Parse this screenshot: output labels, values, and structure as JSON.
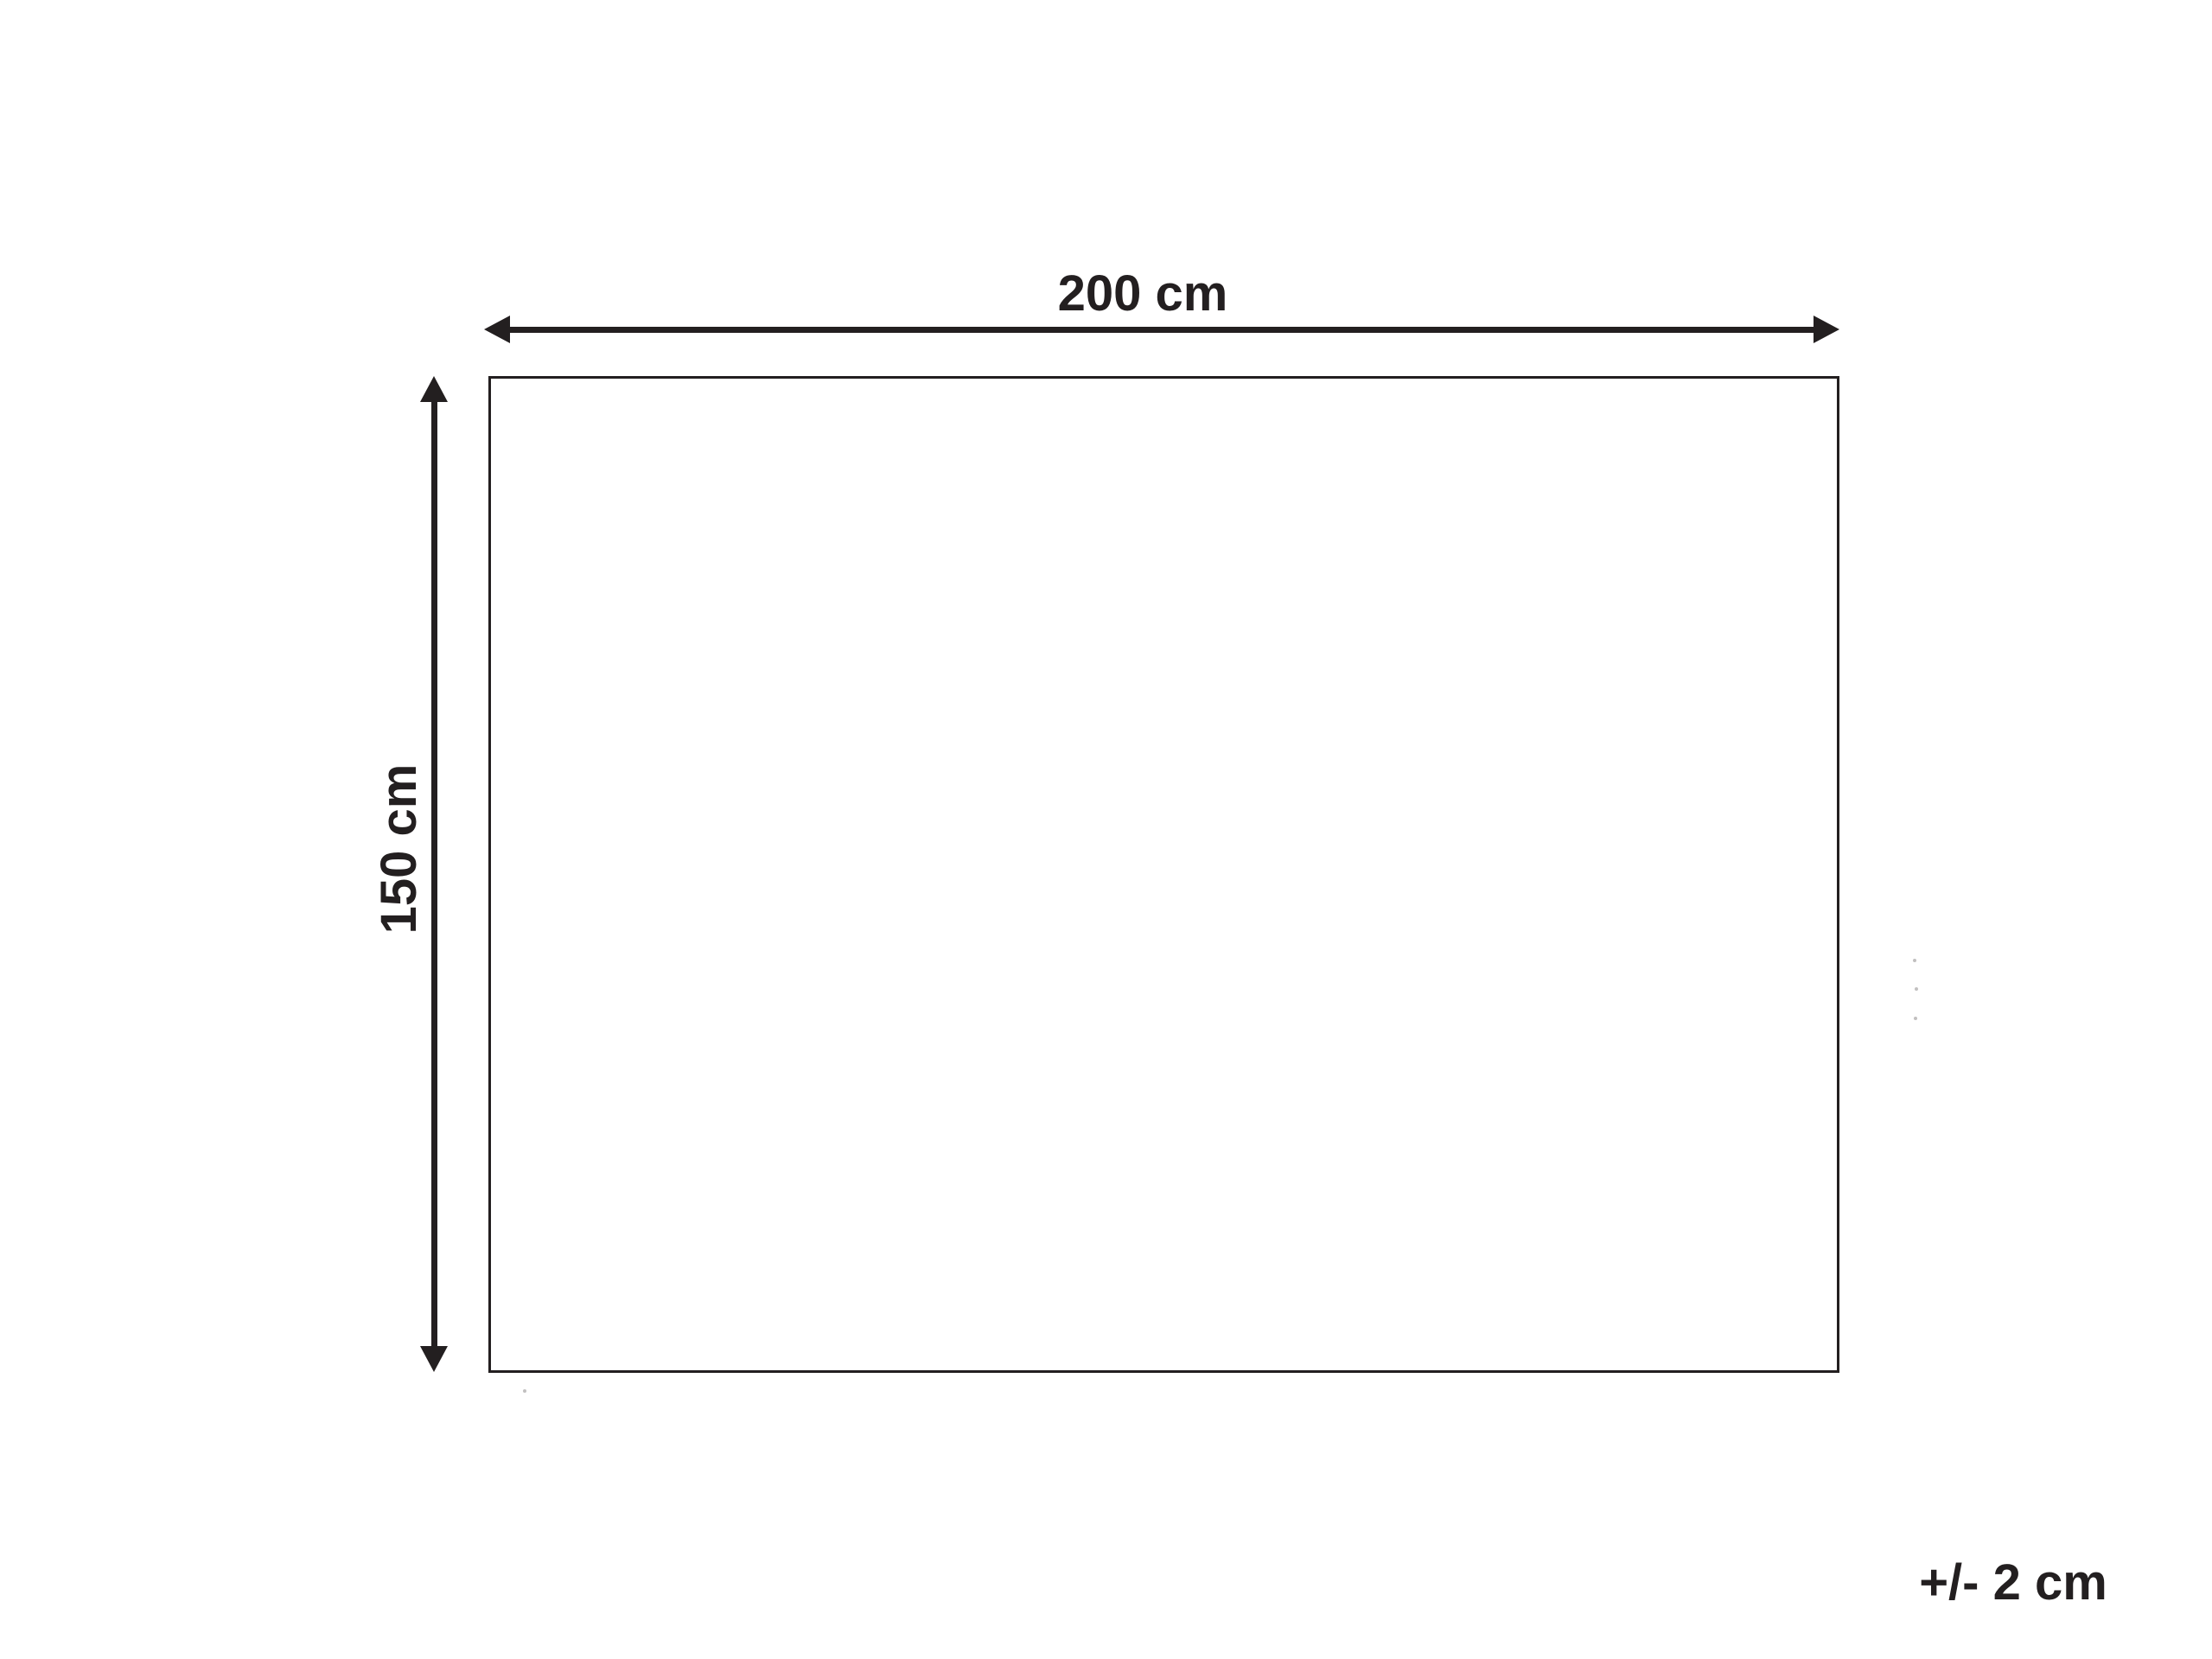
{
  "diagram": {
    "width_label": "200 cm",
    "height_label": "150 cm",
    "tolerance_label": "+/- 2 cm",
    "width_cm": 200,
    "height_cm": 150,
    "tolerance_cm": 2,
    "ink_color": "#231f20",
    "background_color": "#ffffff"
  }
}
